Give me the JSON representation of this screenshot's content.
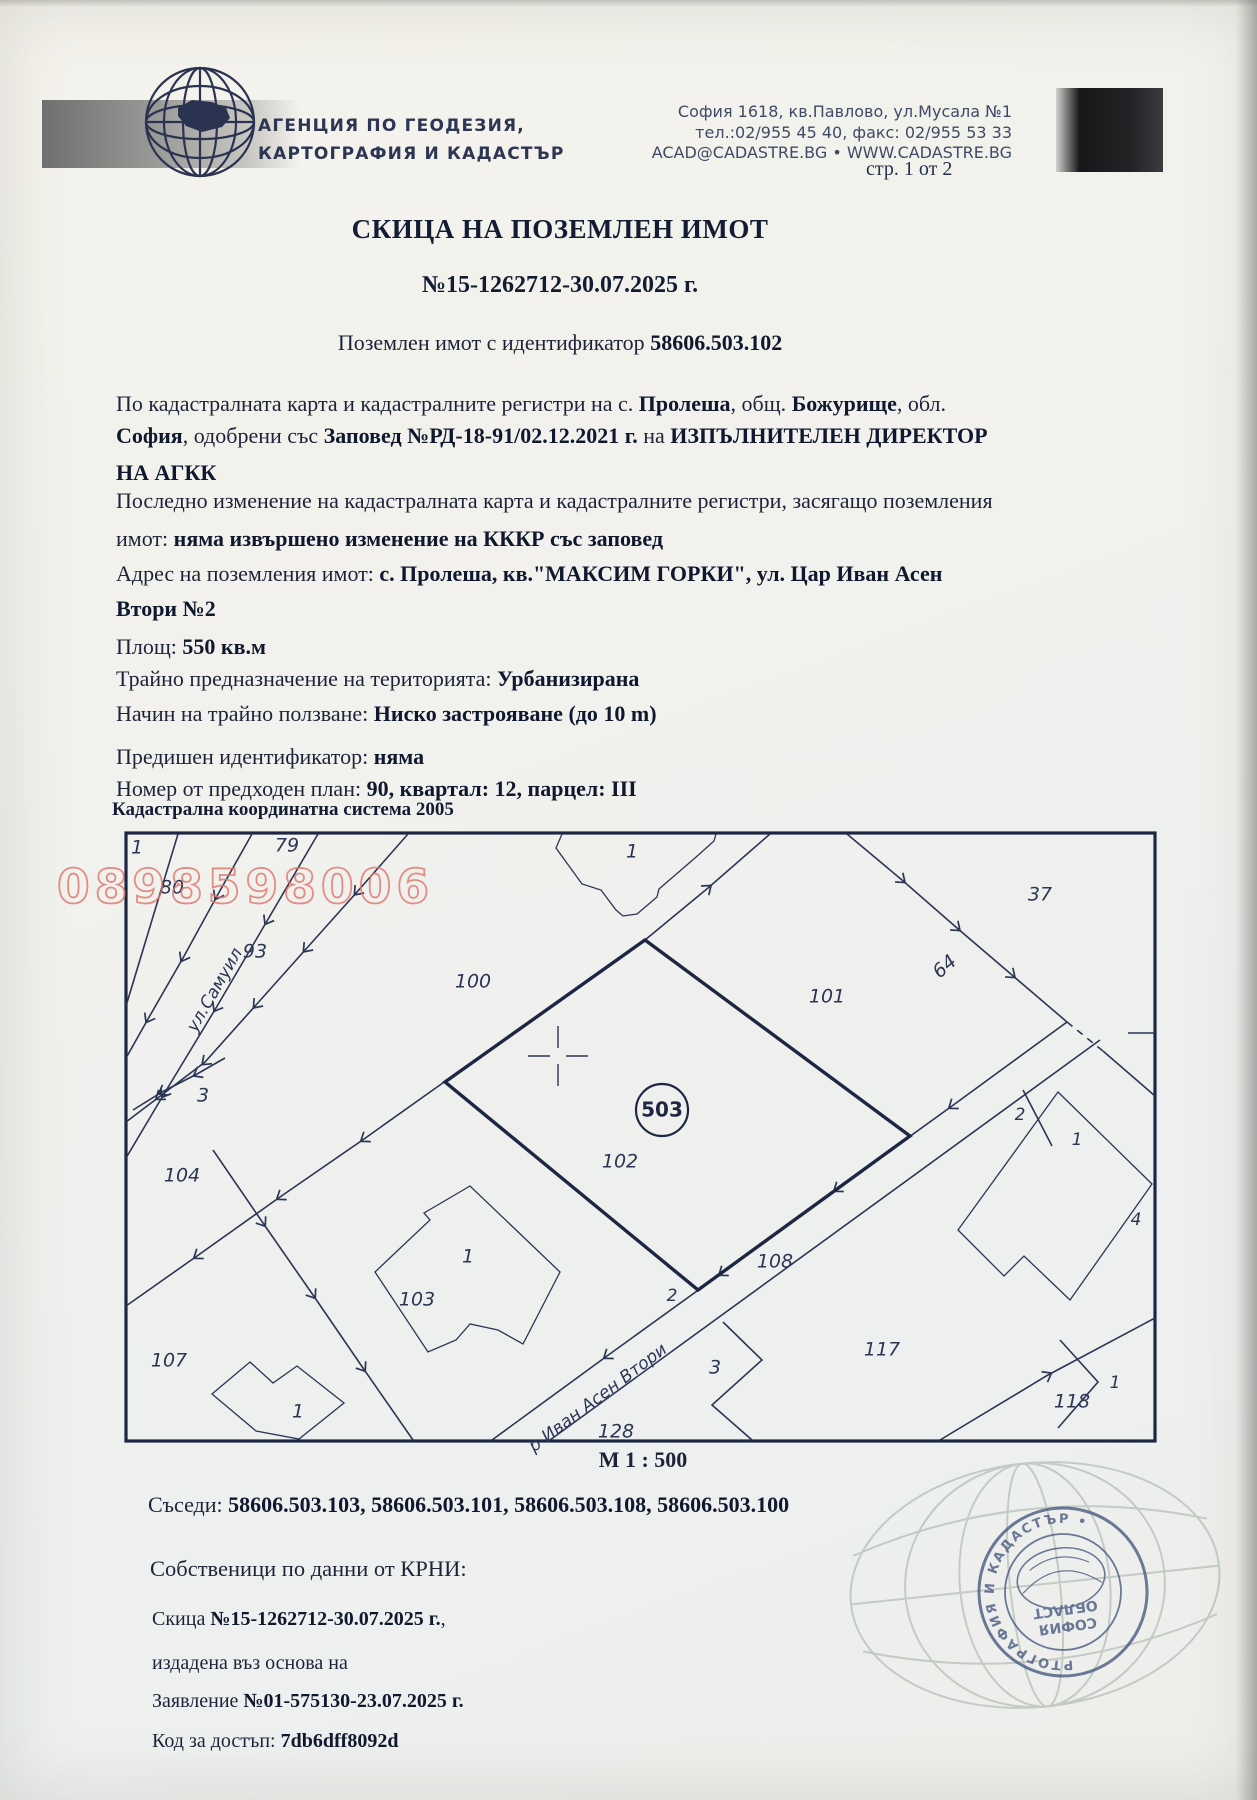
{
  "page_indicator": "стр. 1 от 2",
  "header": {
    "agency_line1": "АГЕНЦИЯ ПО ГЕОДЕЗИЯ,",
    "agency_line2": "КАРТОГРАФИЯ И КАДАСТЪР",
    "address_line1": "София 1618, кв.Павлово, ул.Мусала №1",
    "address_line2": "тел.:02/955 45 40, факс: 02/955 53 33",
    "address_line3": "ACAD@CADASTRE.BG • WWW.CADASTRE.BG"
  },
  "title": {
    "main": "СКИЦА НА ПОЗЕМЛЕН ИМОТ",
    "number": "№15-1262712-30.07.2025 г.",
    "subtitle": [
      {
        "t": "Поземлен имот с идентификатор "
      },
      {
        "t": "58606.503.102",
        "b": 1
      }
    ]
  },
  "body": {
    "lines": [
      [
        {
          "t": "По кадастралната карта и кадастралните регистри на с. "
        },
        {
          "t": "Пролеша",
          "b": 1
        },
        {
          "t": ", общ. "
        },
        {
          "t": "Божурище",
          "b": 1
        },
        {
          "t": ", обл."
        }
      ],
      [
        {
          "t": "София",
          "b": 1
        },
        {
          "t": ", одобрени със "
        },
        {
          "t": "Заповед №РД-18-91/02.12.2021 г.",
          "b": 1
        },
        {
          "t": " на "
        },
        {
          "t": "ИЗПЪЛНИТЕЛЕН ДИРЕКТОР",
          "b": 1
        }
      ],
      [
        {
          "t": "НА АГКК",
          "b": 1
        }
      ],
      [
        {
          "t": "Последно изменение на кадастралната карта и кадастралните регистри, засягащо поземления"
        }
      ],
      [
        {
          "t": "имот: "
        },
        {
          "t": "няма извършено изменение на КККР със заповед",
          "b": 1
        }
      ],
      [
        {
          "t": "Адрес на поземления имот: "
        },
        {
          "t": "с. Пролеша, кв.\"МАКСИМ ГОРКИ\", ул. Цар Иван Асен",
          "b": 1
        }
      ],
      [
        {
          "t": "Втори №2",
          "b": 1
        }
      ],
      [
        {
          "t": "Площ: "
        },
        {
          "t": "550 кв.м",
          "b": 1
        }
      ],
      [
        {
          "t": "Трайно предназначение на територията: "
        },
        {
          "t": "Урбанизирана",
          "b": 1
        }
      ],
      [
        {
          "t": "Начин на трайно ползване: "
        },
        {
          "t": "Ниско застрояване (до 10 m)",
          "b": 1
        }
      ],
      [
        {
          "t": "Предишен идентификатор: "
        },
        {
          "t": "няма",
          "b": 1
        }
      ],
      [
        {
          "t": "Номер от предходен план: "
        },
        {
          "t": "90, квартал: 12, парцел: III",
          "b": 1
        }
      ]
    ]
  },
  "map": {
    "system_label": "Кадастрална координатна система 2005",
    "scale_label": "М 1 : 500",
    "watermark": "0898598006",
    "point_badge": "503",
    "labels": [
      {
        "t": "1"
      },
      {
        "t": "79"
      },
      {
        "t": "80"
      },
      {
        "t": "93"
      },
      {
        "t": "ул.Самуил"
      },
      {
        "t": "100"
      },
      {
        "t": "1"
      },
      {
        "t": "101"
      },
      {
        "t": "64"
      },
      {
        "t": "37"
      },
      {
        "t": "3"
      },
      {
        "t": "104"
      },
      {
        "t": "102"
      },
      {
        "t": "2"
      },
      {
        "t": "108"
      },
      {
        "t": "117"
      },
      {
        "t": "3"
      },
      {
        "t": "128"
      },
      {
        "t": "р Иван Асен Втори"
      },
      {
        "t": "1"
      },
      {
        "t": "103"
      },
      {
        "t": "1"
      },
      {
        "t": "107"
      },
      {
        "t": "2"
      },
      {
        "t": "1"
      },
      {
        "t": "4"
      },
      {
        "t": "118"
      },
      {
        "t": "1"
      }
    ]
  },
  "footer": {
    "neighbors": [
      {
        "t": "Съседи: "
      },
      {
        "t": "58606.503.103, 58606.503.101, 58606.503.108, 58606.503.100",
        "b": 1
      }
    ],
    "owners_heading": "Собственици по данни от КРНИ:",
    "sketch_line": [
      {
        "t": "Скица "
      },
      {
        "t": "№15-1262712-30.07.2025 г.",
        "b": 1
      },
      {
        "t": ","
      }
    ],
    "issued_line": "издадена въз основа на",
    "application_line": [
      {
        "t": "Заявление "
      },
      {
        "t": "№01-575130-23.07.2025 г.",
        "b": 1
      }
    ],
    "access_line": [
      {
        "t": "Код за достъп: "
      },
      {
        "t": "7db6dff8092d",
        "b": 1
      }
    ]
  },
  "stamp": {
    "ring_text": "СЛУЖБА ПО ГЕОДЕЗИЯ, КАРТОГРАФИЯ И КАДАСТЪР •",
    "center_line1": "СОФИЯ",
    "center_line2": "ОБЛАСТ"
  },
  "colors": {
    "ink": "#1c2338",
    "map_ink": "#2b3554",
    "watermark": "#e0736b",
    "stamp": "#44577d"
  }
}
